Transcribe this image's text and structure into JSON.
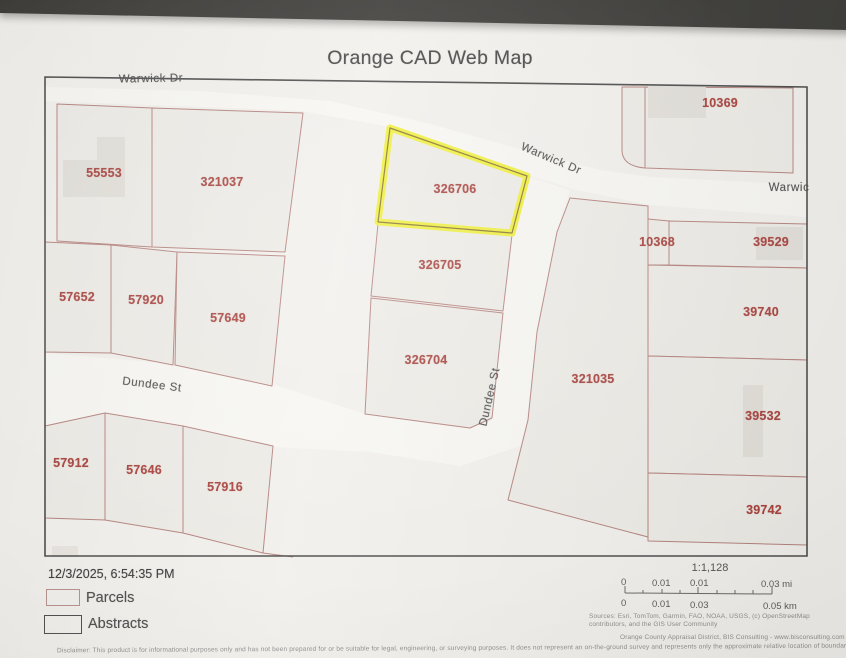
{
  "theme": {
    "band": "#3f3e3b",
    "paper": "#f2f0ec",
    "map_bg": "#edebe6",
    "road_fill": "#f7f6f2",
    "parcel_line": "#b5837e",
    "parcel_label": "#a8433e",
    "street_label": "#505050",
    "building": "#e2dfd9",
    "highlight": "#efef3e",
    "highlight_inner": "#8a7430",
    "map_border": "#4d4d4d",
    "title_color": "#474747",
    "footer_text": "#3d3d3d",
    "fine_text": "#8f8f8f"
  },
  "title": "Orange CAD Web Map",
  "map": {
    "highlighted_parcel": "326706",
    "parcels": [
      {
        "label": "55553"
      },
      {
        "label": "321037"
      },
      {
        "label": "10369"
      },
      {
        "label": "326706"
      },
      {
        "label": "57652"
      },
      {
        "label": "57920"
      },
      {
        "label": "57649"
      },
      {
        "label": "326705"
      },
      {
        "label": "326704"
      },
      {
        "label": "10368"
      },
      {
        "label": "39529"
      },
      {
        "label": "39740"
      },
      {
        "label": "321035"
      },
      {
        "label": "39532"
      },
      {
        "label": "39742"
      },
      {
        "label": "57912"
      },
      {
        "label": "57646"
      },
      {
        "label": "57916"
      }
    ],
    "streets": [
      {
        "label": "Warwick Dr"
      },
      {
        "label": "Warwick Dr"
      },
      {
        "label": "Warwic"
      },
      {
        "label": "Dundee St"
      },
      {
        "label": "Dundee St"
      }
    ]
  },
  "footer": {
    "timestamp": "12/3/2025, 6:54:35 PM",
    "legend": [
      {
        "label": "Parcels"
      },
      {
        "label": "Abstracts"
      }
    ],
    "scale_ratio": "1:1,128",
    "scale_mi": [
      "0",
      "0.01",
      "0.01",
      "0.03 mi"
    ],
    "scale_km": [
      "0",
      "0.01",
      "0.03",
      "0.05 km"
    ],
    "sources_line1": "Sources: Esri, TomTom, Garmin, FAO, NOAA, USGS, (c) OpenStreetMap",
    "sources_line2": "contributors, and the GIS User Community",
    "credit": "Orange County Appraisal District, BIS Consulting - www.bisconsulting.com",
    "disclaimer": "Disclaimer: This product is for informational purposes only and has not been prepared for or be suitable for legal, engineering, or surveying purposes. It does not represent an on-the-ground survey and represents only the approximate relative location of boundaries."
  }
}
